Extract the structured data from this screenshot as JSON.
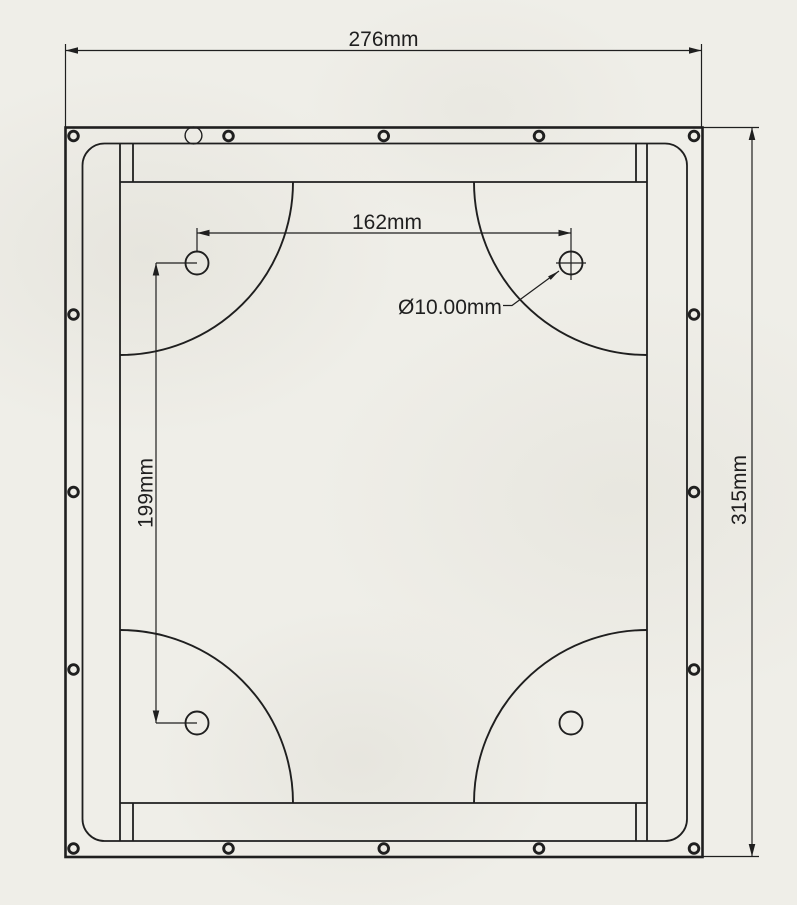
{
  "page": {
    "paper_color": "#efeee8",
    "line_color": "#1f1f1f"
  },
  "drawing": {
    "kind": "technical-drawing",
    "units": "mm",
    "dimensions": {
      "overall_width": {
        "label": "276mm",
        "value": 276
      },
      "overall_height": {
        "label": "315mm",
        "value": 315
      },
      "hole_pitch_x": {
        "label": "162mm",
        "value": 162
      },
      "hole_pitch_y": {
        "label": "199mm",
        "value": 199
      },
      "hole_diameter": {
        "label": "Ø10.00mm",
        "value": 10
      }
    },
    "features": {
      "mounting_holes": 4,
      "perimeter_screw_holes": 16,
      "corner_relief_arcs": 4,
      "top_edge_round_hole": 1
    }
  }
}
